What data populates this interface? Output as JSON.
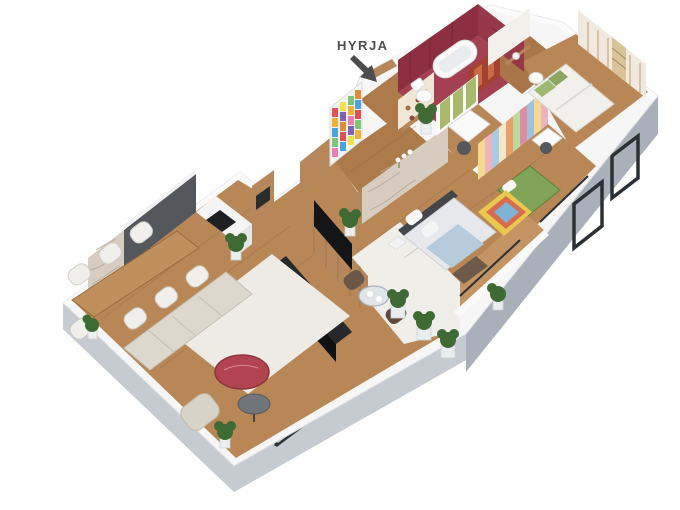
{
  "annotation": {
    "label": "HYRJA"
  },
  "palette": {
    "background": "#ffffff",
    "wall_top": "#f6f6f7",
    "wall_side": "#e2e4e7",
    "plinth_gray": "#b8bec6",
    "plinth_gray_dark": "#aab0b9",
    "plinth_gray_light": "#c6cbd2",
    "wood_floor": "#b98756",
    "wood_floor_light": "#c49463",
    "wood_wall": "#b5875a",
    "stone_wall": "#d6cdc0",
    "kitchen_cabinet_gray": "#54575c",
    "bath_wall_red": "#8c2f40",
    "bath_wall_red_light": "#97384a",
    "bath_floor_red": "#a34052",
    "shower_art_red": "#a5412f",
    "tv_black": "#141517",
    "sofa_beige": "#dcd8ce",
    "rug_cream": "#edebe4",
    "coffee_table_red": "#b24350",
    "kids_bed_green": "#7fa457",
    "study_panel_green": "#a9b96c",
    "plant_green": "#3e6a34",
    "frame_dark": "#2b3035",
    "label_gray": "#4d4d4d"
  }
}
